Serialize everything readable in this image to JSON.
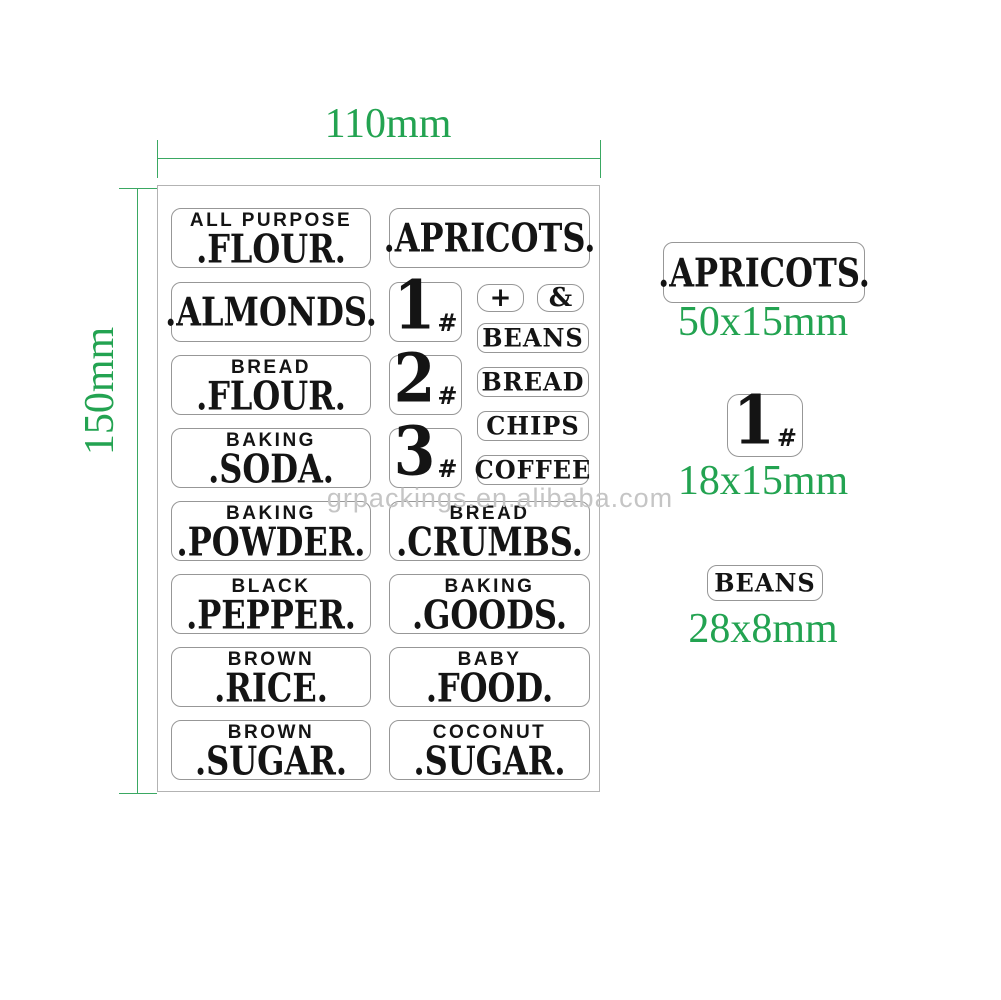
{
  "colors": {
    "dimension_green": "#23a351",
    "dimension_line_green": "#3aa862",
    "label_border_gray": "#979797",
    "sheet_border_gray": "#b3b3b3",
    "label_text_black": "#141414",
    "watermark_gray": "#c5c5c5"
  },
  "dimensions": {
    "sheet_width_label": "110mm",
    "sheet_height_label": "150mm"
  },
  "watermark": {
    "text": "grpackings.en.alibaba.com"
  },
  "sheet": {
    "left_column": [
      {
        "header": "ALL PURPOSE",
        "main": ".FLOUR."
      },
      {
        "header": "",
        "main": ".ALMONDS."
      },
      {
        "header": "BREAD",
        "main": ".FLOUR."
      },
      {
        "header": "BAKING",
        "main": ".SODA."
      },
      {
        "header": "BAKING",
        "main": ".POWDER."
      },
      {
        "header": "BLACK",
        "main": ".PEPPER."
      },
      {
        "header": "BROWN",
        "main": ".RICE."
      },
      {
        "header": "BROWN",
        "main": ".SUGAR."
      }
    ],
    "right_column_large": [
      {
        "header": "",
        "main": ".APRICOTS."
      },
      {
        "header": "BREAD",
        "main": ".CRUMBS."
      },
      {
        "header": "BAKING",
        "main": ".GOODS."
      },
      {
        "header": "BABY",
        "main": ".FOOD."
      },
      {
        "header": "COCONUT",
        "main": ".SUGAR."
      }
    ],
    "number_labels": [
      {
        "digit": "1",
        "suffix": "#"
      },
      {
        "digit": "2",
        "suffix": "#"
      },
      {
        "digit": "3",
        "suffix": "#"
      }
    ],
    "symbol_labels": [
      "+",
      "&"
    ],
    "small_labels": [
      "BEANS",
      "BREAD",
      "CHIPS",
      "COFFEE"
    ]
  },
  "samples": {
    "large": {
      "text": ".APRICOTS.",
      "size": "50x15mm"
    },
    "number": {
      "digit": "1",
      "suffix": "#",
      "size": "18x15mm"
    },
    "small": {
      "text": "BEANS",
      "size": "28x8mm"
    }
  }
}
